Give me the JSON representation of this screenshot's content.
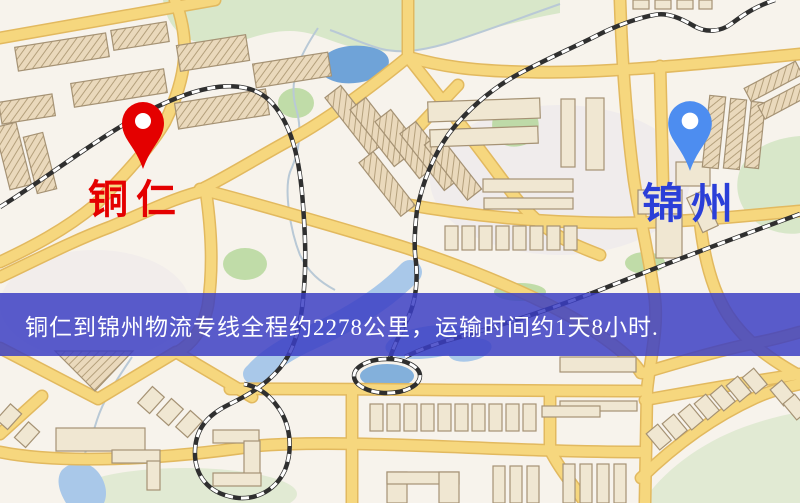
{
  "map": {
    "markers": {
      "origin": {
        "label": "铜仁",
        "pin_icon": "red-map-pin"
      },
      "destination": {
        "label": "锦州",
        "pin_icon": "blue-map-pin"
      }
    }
  },
  "banner": {
    "text": "铜仁到锦州物流专线全程约2278公里，运输时间约1天8小时."
  },
  "route_info": {
    "origin": "铜仁",
    "destination": "锦州",
    "distance_km": "2278",
    "duration": "1天8小时"
  },
  "theme": {
    "map_bg": "#f7f3ec",
    "road_fill": "#f6d77e",
    "road_casing": "#e2b95f",
    "building_fill": "#f0e7d2",
    "building_stroke": "#a59274",
    "green": "#cfe3c0",
    "green_bright": "#add492",
    "green_pale": "#dfe9d2",
    "water": "#6fa3d8",
    "water_light": "#a9c8e9",
    "rail_dark": "#2f2f2f",
    "banner_bg": "rgba(58,62,196,0.84)",
    "banner_text": "#ffffff",
    "origin_color": "#e40000",
    "dest_pin": "#4d8df0",
    "dest_text": "#2b3fd8"
  }
}
